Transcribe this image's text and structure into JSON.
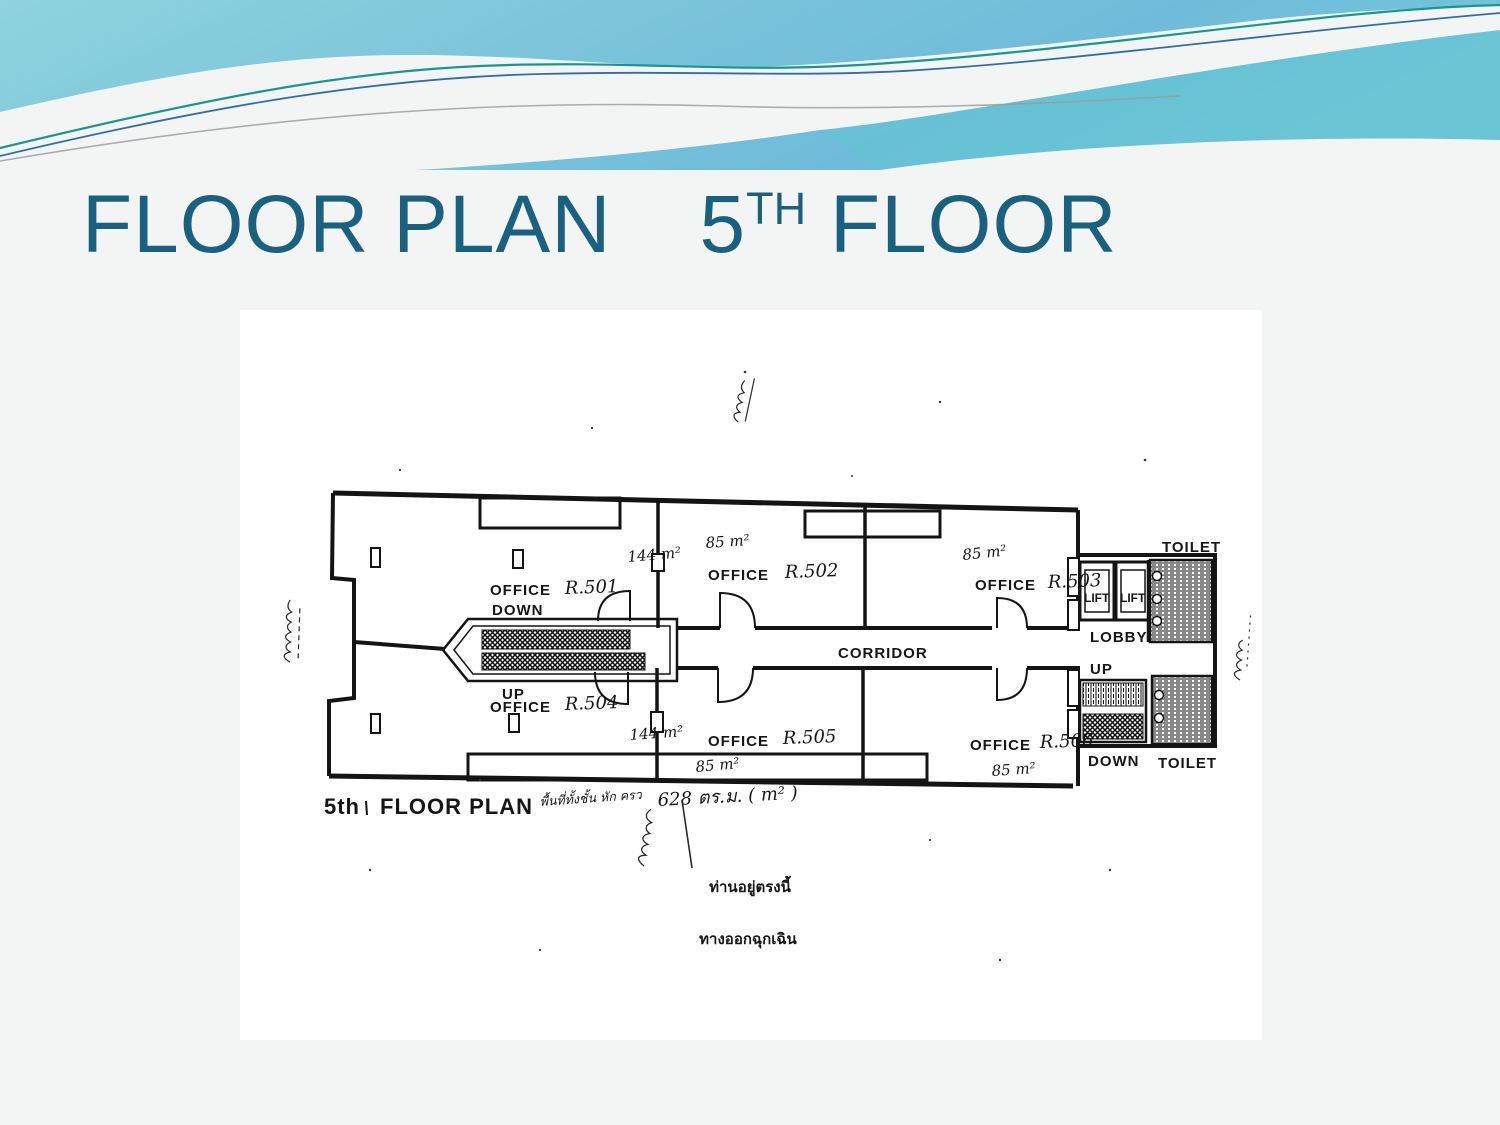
{
  "slide": {
    "title": {
      "part1": "FLOOR PLAN",
      "number": "5",
      "superscript": "TH",
      "part2": " FLOOR"
    }
  },
  "plan": {
    "caption": {
      "floor": "5th",
      "text": "FLOOR PLAN"
    },
    "handwritten": {
      "note": "พื้นที่ทั้งชั้น หัก ครว",
      "total_area": "628 ตร.ม. ( m² )"
    },
    "notices": {
      "you_are_here": "ท่านอยู่ตรงนี้",
      "emergency_exit": "ทางออกฉุกเฉิน"
    },
    "labels": {
      "corridor": "CORRIDOR",
      "lobby": "LOBBY",
      "lift": "LIFT",
      "toilet": "TOILET",
      "up": "UP",
      "down": "DOWN"
    },
    "rooms": [
      {
        "office": "OFFICE",
        "number": "R.501",
        "area": "144 m²"
      },
      {
        "office": "OFFICE",
        "number": "R.502",
        "area": "85 m²"
      },
      {
        "office": "OFFICE",
        "number": "R.503",
        "area": "85 m²"
      },
      {
        "office": "OFFICE",
        "number": "R.504",
        "area": "144 m²"
      },
      {
        "office": "OFFICE",
        "number": "R.505",
        "area": "85 m²"
      },
      {
        "office": "OFFICE",
        "number": "R.506",
        "area": "85 m²"
      }
    ]
  },
  "colors": {
    "title": "#1a607f",
    "banner_blue": "#7cc5da",
    "accent_teal": "#17988f",
    "accent_blue": "#2f6fa8"
  }
}
